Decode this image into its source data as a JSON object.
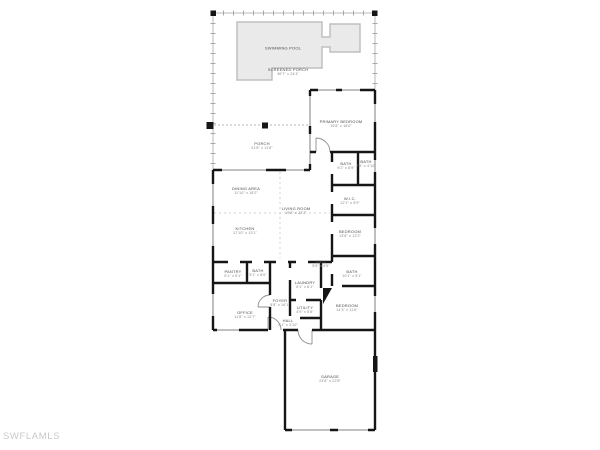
{
  "watermark": "SWFLAMLS",
  "colors": {
    "wall": "#161616",
    "window": "#9c9c9c",
    "pool_fill": "#eaeaea",
    "pool_border": "#c0c0c0",
    "screen_line": "#b5b5b5",
    "label_text": "#4a4a4a",
    "dims_text": "#8a8a8a",
    "watermark_text": "#c9c9c9"
  },
  "plan": {
    "rooms": [
      {
        "name": "SWIMMING POOL",
        "dims": ""
      },
      {
        "name": "SCREENED PORCH",
        "dims": "36'7\" x 24'4\""
      },
      {
        "name": "PORCH",
        "dims": "21'8\" x 11'8\""
      },
      {
        "name": "PRIMARY BEDROOM",
        "dims": "15'8\" x 18'0\""
      },
      {
        "name": "BATH",
        "dims": "9'2\" x 6'9\""
      },
      {
        "name": "BATH",
        "dims": "7'4\" x 4'10\""
      },
      {
        "name": "W.I.C.",
        "dims": "12'1\" x 5'9\""
      },
      {
        "name": "DINING AREA",
        "dims": "11'10\" x 15'2\""
      },
      {
        "name": "LIVING ROOM",
        "dims": "19'8\" x 23'2\""
      },
      {
        "name": "KITCHEN",
        "dims": "17'10\" x 13'1\""
      },
      {
        "name": "BEDROOM",
        "dims": "13'8\" x 12'2\""
      },
      {
        "name": "PANTRY",
        "dims": "5'1\" x 5'1\""
      },
      {
        "name": "BATH",
        "dims": "5'1\" x 8'0\""
      },
      {
        "name": "HALL",
        "dims": "5'5\" x 4'5\""
      },
      {
        "name": "LAUNDRY",
        "dims": "6'1\" x 6'1\""
      },
      {
        "name": "BATH",
        "dims": "10'1\" x 5'1\""
      },
      {
        "name": "FOYER",
        "dims": "5'8\" x 16'1\""
      },
      {
        "name": "UTILITY",
        "dims": "4'9\" x 5'8\""
      },
      {
        "name": "HALL",
        "dims": "4'1\" x 3'10\""
      },
      {
        "name": "OFFICE",
        "dims": "11'8\" x 12'7\""
      },
      {
        "name": "BEDROOM",
        "dims": "14'3\" x 11'6\""
      },
      {
        "name": "GARAGE",
        "dims": "23'8\" x 22'8\""
      }
    ]
  }
}
